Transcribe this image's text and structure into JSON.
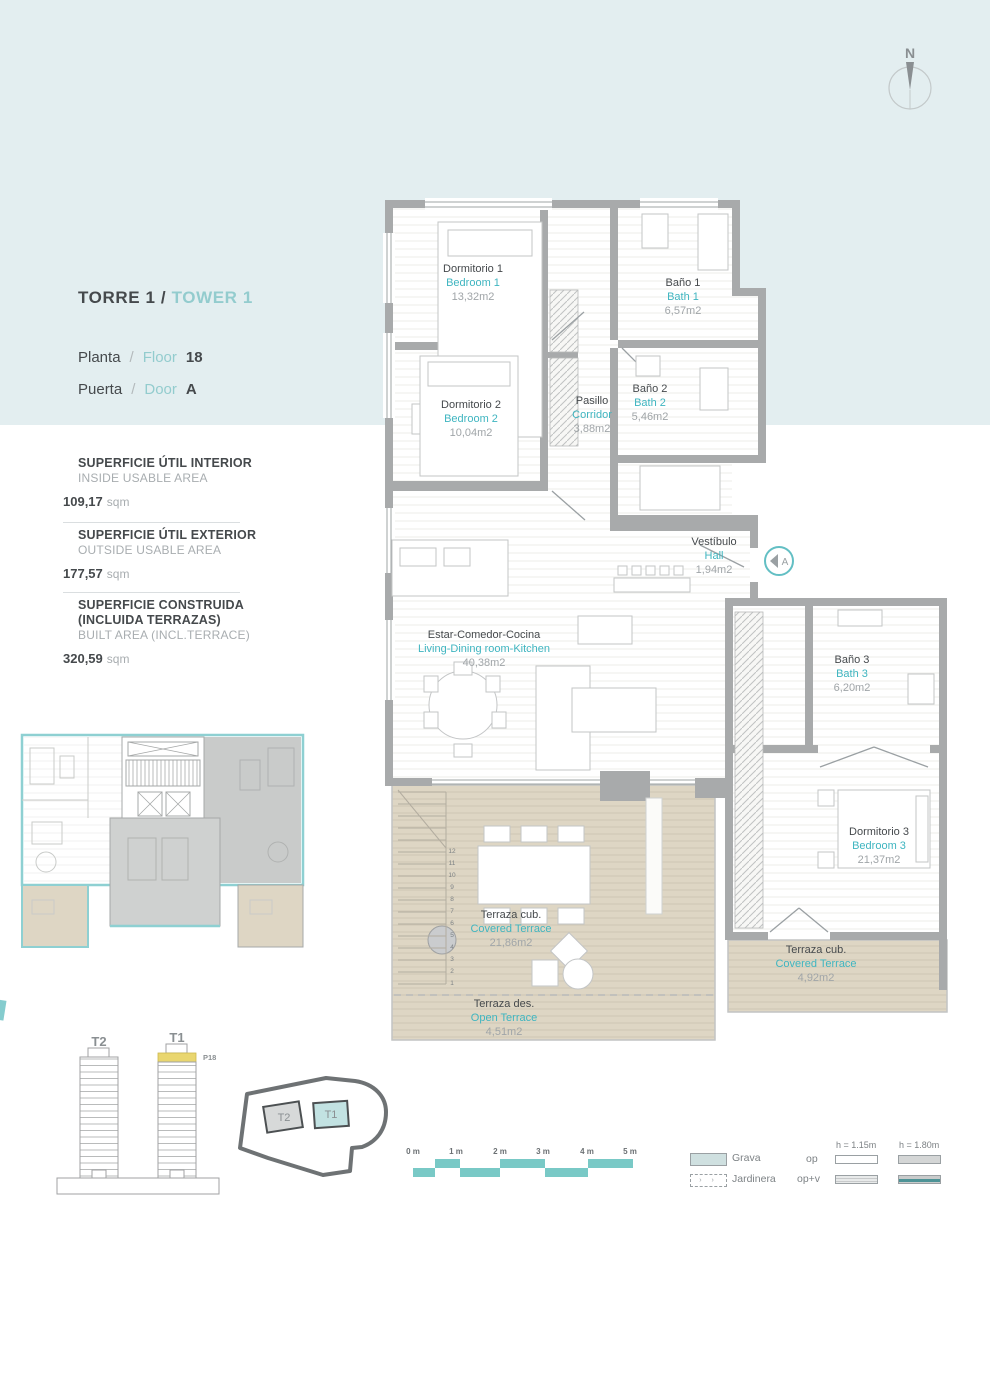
{
  "header": {
    "torre": "TORRE 1",
    "sep": "/",
    "tower": "TOWER 1",
    "planta_label": "Planta",
    "floor_label": "Floor",
    "floor_value": "18",
    "puerta_label": "Puerta",
    "door_label": "Door",
    "door_value": "A"
  },
  "compass": {
    "label": "N"
  },
  "area_panel": {
    "blocks": [
      {
        "title_es": "SUPERFICIE ÚTIL INTERIOR",
        "title_en": "INSIDE USABLE AREA",
        "value": "109,17",
        "unit": "sqm"
      },
      {
        "title_es": "SUPERFICIE ÚTIL EXTERIOR",
        "title_en": "OUTSIDE USABLE AREA",
        "value": "177,57",
        "unit": "sqm"
      },
      {
        "title_es": "SUPERFICIE CONSTRUIDA (INCLUIDA TERRAZAS)",
        "title_en": "BUILT AREA (INCL.TERRACE)",
        "value": "320,59",
        "unit": "sqm"
      }
    ]
  },
  "plan": {
    "rooms": {
      "dorm1": {
        "es": "Dormitorio 1",
        "en": "Bedroom 1",
        "area": "13,32m2"
      },
      "bath1": {
        "es": "Baño 1",
        "en": "Bath 1",
        "area": "6,57m2"
      },
      "dorm2": {
        "es": "Dormitorio 2",
        "en": "Bedroom 2",
        "area": "10,04m2"
      },
      "pasillo": {
        "es": "Pasillo",
        "en": "Corridor",
        "area": "3,88m2"
      },
      "bath2": {
        "es": "Baño 2",
        "en": "Bath 2",
        "area": "5,46m2"
      },
      "hall": {
        "es": "Vestíbulo",
        "en": "Hall",
        "area": "1,94m2"
      },
      "living": {
        "es": "Estar-Comedor-Cocina",
        "en": "Living-Dining room-Kitchen",
        "area": "40,38m2"
      },
      "bath3": {
        "es": "Baño 3",
        "en": "Bath 3",
        "area": "6,20m2"
      },
      "dorm3": {
        "es": "Dormitorio 3",
        "en": "Bedroom 3",
        "area": "21,37m2"
      },
      "terrace_cov1": {
        "es": "Terraza cub.",
        "en": "Covered Terrace",
        "area": "21,86m2"
      },
      "terrace_open": {
        "es": "Terraza des.",
        "en": "Open Terrace",
        "area": "4,51m2"
      },
      "terrace_cov2": {
        "es": "Terraza cub.",
        "en": "Covered Terrace",
        "area": "4,92m2"
      }
    },
    "entry_badge": "A",
    "stairs": [
      "12",
      "11",
      "10",
      "9",
      "8",
      "7",
      "6",
      "5",
      "4",
      "3",
      "2",
      "1"
    ]
  },
  "towers": {
    "t2": "T2",
    "t1": "T1",
    "floor_tag": "P18"
  },
  "site_plan": {
    "t2": "T2",
    "t1": "T1"
  },
  "scalebar": {
    "labels": [
      "0 m",
      "1 m",
      "2 m",
      "3 m",
      "4 m",
      "5 m"
    ]
  },
  "legend": {
    "grava": "Grava",
    "jardinera": "Jardinera",
    "op": "op",
    "opv": "op+v",
    "h115": "h = 1.15m",
    "h180": "h = 1.80m"
  },
  "colors": {
    "banner": "#e3eef0",
    "accent_teal": "#3fb5c0",
    "light_teal": "#93ccce",
    "wall_gray": "#a8aaab",
    "terrace_beige": "#ded6c4",
    "highlight_yellow": "#e9d66f",
    "scale_teal": "#79c9c6"
  }
}
